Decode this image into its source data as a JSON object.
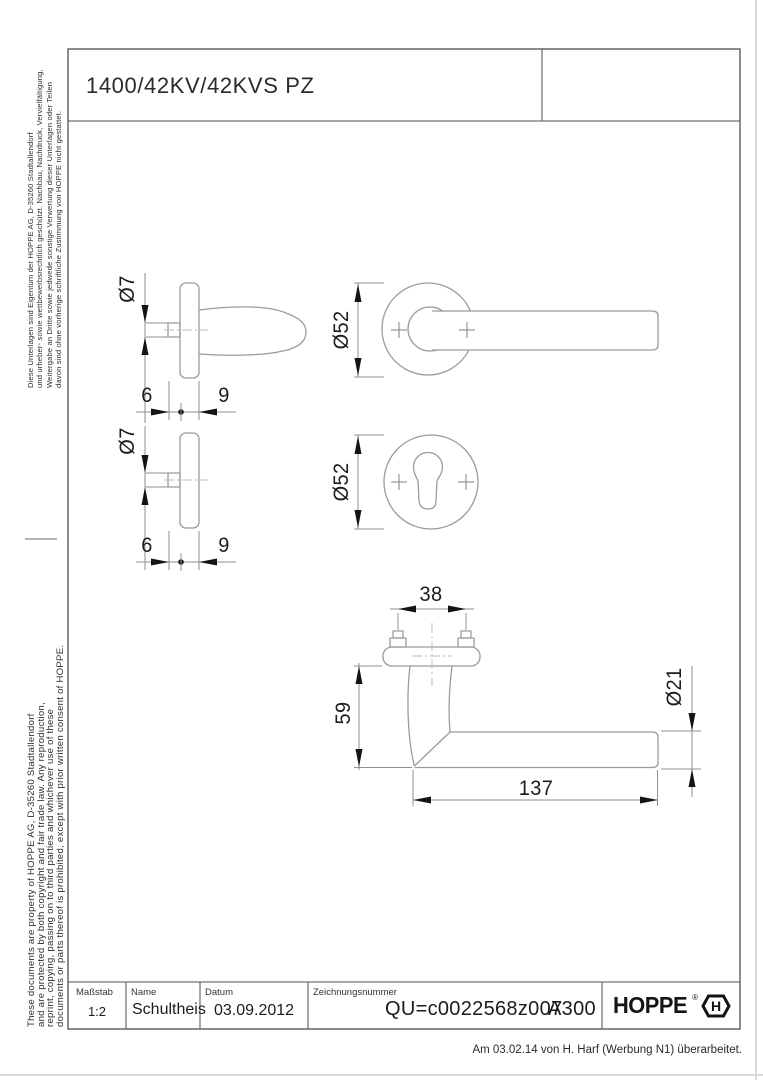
{
  "page": {
    "title": "1400/42KV/42KVS PZ"
  },
  "legal_de": {
    "lines": [
      "Diese Unterlagen sind Eigentum der  HOPPE AG, D-35260 Stadtallendorf",
      "und urheber- sowie wettbewerbsrechtlich geschützt. Nachbau, Nachdruck, Vervielfältigung,",
      "Weitergabe an Dritte sowie jedwede sonstige Verwertung dieser Unterlagen oder Teilen",
      "davon sind ohne vorherige schriftliche Zustimmung von HOPPE nicht gestattet."
    ]
  },
  "legal_en": {
    "lines": [
      "These documents are property of  HOPPE AG, D-35260 Stadtallendorf",
      "and are protected by both copyright and fair trade law. Any reproduction,",
      "reprint, copying, passing on to third parties and whichever use of these",
      "documents or parts thereof is prohibited, except with prior written consent of  HOPPE."
    ]
  },
  "dimensions": {
    "spindle_diameter_top": "Ø7",
    "backset_left_top": "6",
    "backset_right_top": "9",
    "spindle_diameter_bottom": "Ø7",
    "backset_left_bottom": "6",
    "backset_right_bottom": "9",
    "rose_diameter_handle": "Ø52",
    "rose_diameter_key": "Ø52",
    "screw_spacing": "38",
    "handle_projection": "59",
    "grip_diameter": "Ø21",
    "handle_length": "137"
  },
  "title_block": {
    "scale_label": "Maßstab",
    "scale_value": "1:2",
    "name_label": "Name",
    "name_value": "Schultheis",
    "date_label": "Datum",
    "date_value": "03.09.2012",
    "drawing_number_label": "Zeichnungsnummer",
    "drawing_number_value": "QU=c0022568z007",
    "revision": "A300",
    "logo_text": "HOPPE",
    "logo_registered": "®",
    "logo_hexagon_letter": "H"
  },
  "footer": {
    "note": "Am 03.02.14 von H. Harf (Werbung N1) überarbeitet."
  }
}
